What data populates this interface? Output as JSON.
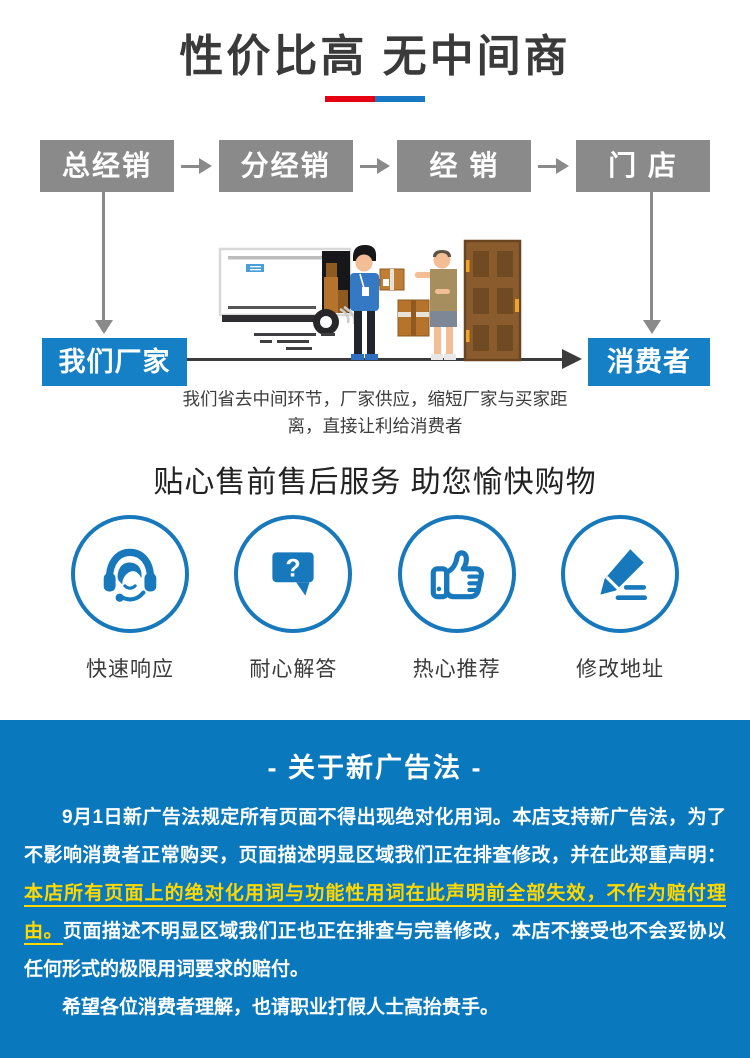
{
  "header": {
    "title": "性价比高 无中间商"
  },
  "flow": {
    "top_boxes": [
      "总经销",
      "分经销",
      "经 销",
      "门 店"
    ],
    "factory_label": "我们厂家",
    "consumer_label": "消费者",
    "caption": "我们省去中间环节，厂家供应，缩短厂家与买家距离，直接让利给消费者"
  },
  "services": {
    "title": "贴心售前售后服务 助您愉快购物",
    "items": [
      {
        "icon": "headset-icon",
        "label": "快速响应"
      },
      {
        "icon": "question-bubble-icon",
        "label": "耐心解答",
        "glyph": "?"
      },
      {
        "icon": "thumbs-up-icon",
        "label": "热心推荐"
      },
      {
        "icon": "pencil-icon",
        "label": "修改地址"
      }
    ]
  },
  "notice": {
    "title": "- 关于新广告法 -",
    "p1_white": "9月1日新广告法规定所有页面不得出现绝对化用词。本店支持新广告法，为了不影响消费者正常购买，页面描述明显区域我们正在排查修改，并在此郑重声明：",
    "p1_highlight": "本店所有页面上的绝对化用词与功能性用词在此声明前全部失效，不作为赔付理由。",
    "p1_white2": "页面描述不明显区域我们正也正在排查与完善修改，本店不接受也不会妥协以任何形式的极限用词要求的赔付。",
    "p2": "希望各位消费者理解，也请职业打假人士高抬贵手。"
  },
  "colors": {
    "accent_blue": "#1580c6",
    "section_blue": "#0a78bd",
    "icon_blue": "#1878bc",
    "box_gray": "#8a8a8a",
    "highlight_yellow": "#ffd800",
    "underline_red": "#e60012",
    "underline_blue": "#1779c4"
  }
}
